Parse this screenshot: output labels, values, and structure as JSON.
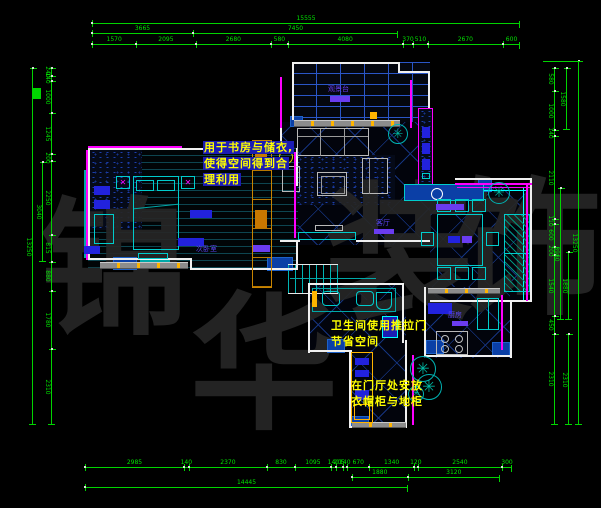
{
  "watermark": {
    "text": "锦华装饰",
    "chars": [
      "锦",
      "华",
      "装",
      "饰"
    ],
    "color": "#262626"
  },
  "annotations": {
    "study": {
      "lines": [
        "用于书房与储衣,",
        "使得空间得到合",
        "理利用"
      ],
      "color": "#ffff00"
    },
    "bathroom": {
      "lines": [
        "卫生间使用推拉门",
        "节省空间"
      ],
      "color": "#ffff00"
    },
    "entry": {
      "lines": [
        "在门厅处安放",
        "衣帽柜与地柜"
      ],
      "color": "#ffff00"
    }
  },
  "rooms": {
    "balcony": "观景台",
    "bedroom": "次卧室",
    "living": "客厅",
    "kitchen": "厨房"
  },
  "dimensions": {
    "top": {
      "total": "15555",
      "sub": [
        "3665",
        "7450"
      ],
      "segments": [
        "1570",
        "2095",
        "2680",
        "580",
        "4080",
        "370",
        "510",
        "2670",
        "600"
      ]
    },
    "bottom": {
      "total": "14445",
      "sub": [
        "1880",
        "3120"
      ],
      "segments": [
        "2985",
        "140",
        "2370",
        "830",
        "1095",
        "140",
        "205",
        "140",
        "670",
        "1340",
        "120",
        "2540",
        "300"
      ]
    },
    "left": {
      "total": "13250",
      "outer": "3040",
      "segments": [
        "240",
        "140",
        "1000",
        "1245",
        "200",
        "2250",
        "815",
        "880",
        "1780",
        "2310"
      ]
    },
    "right": {
      "total": "13250",
      "outer1": "1580",
      "outer2": "3980",
      "outer3": "1880",
      "outer4": "2310",
      "segments": [
        "580",
        "1000",
        "140",
        "2110",
        "110",
        "600",
        "200",
        "1540",
        "450",
        "2310"
      ]
    }
  },
  "colors": {
    "background": "#000000",
    "dimension": "#00d400",
    "wall": "#f0f0f0",
    "accent": "#ff00ff",
    "fixture": "#00ffff",
    "column_fill": "#0a3fa6",
    "annotation": "#ffff00",
    "label": "#5a44f0"
  }
}
